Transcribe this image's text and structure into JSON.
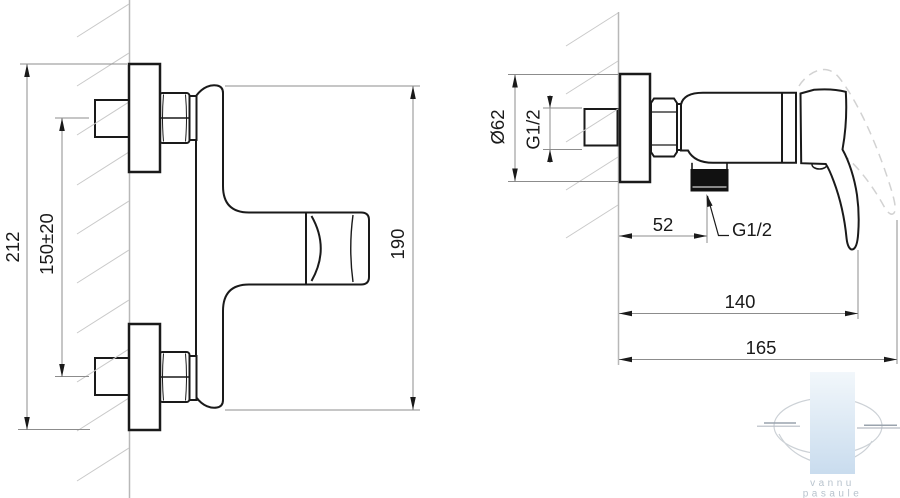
{
  "front_view": {
    "label_overall_height": "212",
    "label_inlet_spacing": "150±20",
    "label_body_height": "190"
  },
  "side_view": {
    "label_escutcheon_diameter": "Ø62",
    "label_inlet_thread": "G1/2",
    "label_outlet_offset": "52",
    "label_outlet_thread": "G1/2",
    "label_depth_to_handle": "140",
    "label_max_depth": "165"
  },
  "watermark": {
    "line1": "vannu",
    "line2": "pasaule"
  },
  "colors": {
    "outline": "#1a1a1a",
    "dimension_lines": "#8c8c8c",
    "wall_line": "#b8b8b8",
    "hatch": "#c9c9c9",
    "dashed_handle": "#d2d2d2",
    "watermark_blue_top": "#f2f7fb",
    "watermark_blue_bottom": "#c9dcee",
    "watermark_text": "#b8c3cd"
  }
}
